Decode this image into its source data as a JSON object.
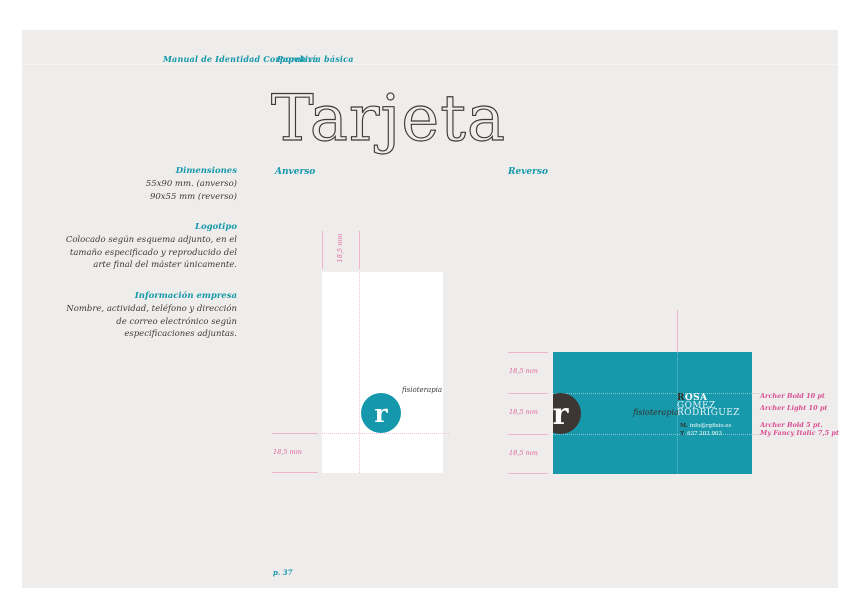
{
  "header": {
    "manual_title": "Manual de Identidad Corporativa",
    "section_title": "Papelería básica"
  },
  "title": "Tarjeta",
  "sidebar": {
    "sections": [
      {
        "heading": "Dimensiones",
        "lines": [
          "55x90 mm. (anverso)",
          "90x55 mm (reverso)"
        ]
      },
      {
        "heading": "Logotipo",
        "lines": [
          "Colocado según esquema adjunto, en el",
          "tamaño especificado y reproducido del",
          "arte final del máster únicamente."
        ]
      },
      {
        "heading": "Información empresa",
        "lines": [
          "Nombre, actividad, teléfono y dirección",
          "de correo electrónico según",
          "especificaciones adjuntas."
        ]
      }
    ]
  },
  "anverso": {
    "label": "Anverso",
    "logo_letter": "r",
    "logo_text": "fisioterapia",
    "measure_top": "18,5 mm",
    "measure_left": "18,5 mm"
  },
  "reverso": {
    "label": "Reverso",
    "logo_letter": "r",
    "name_accent": "R",
    "name_rest": "OSA",
    "name_line2": "GÓMEZ",
    "name_line3": "RODRÍGUEZ",
    "script_text": "fisioterapia",
    "contact1_prefix": "M.",
    "contact1_text": "info@rgfisio.es",
    "contact2_prefix": "T.",
    "contact2_text": "637 203 903",
    "measures": [
      "18,5 mm",
      "18,5 mm",
      "18,5 mm"
    ],
    "annotations_top": [
      "Archer Bold 10 pt",
      "Archer Light 10 pt"
    ],
    "annotations_bottom": [
      "Archer Bold 5 pt.",
      "My Fancy Italic 7,5 pt"
    ]
  },
  "footer": {
    "page_number": "p. 37"
  },
  "colors": {
    "teal": "#1598ab",
    "card_teal": "#1899ab",
    "pink_line": "#eeb3cd",
    "pink_text": "#d94f93",
    "dark": "#3e3a36",
    "dark_circle": "#3d3733",
    "panel_bg": "#efedeb"
  }
}
